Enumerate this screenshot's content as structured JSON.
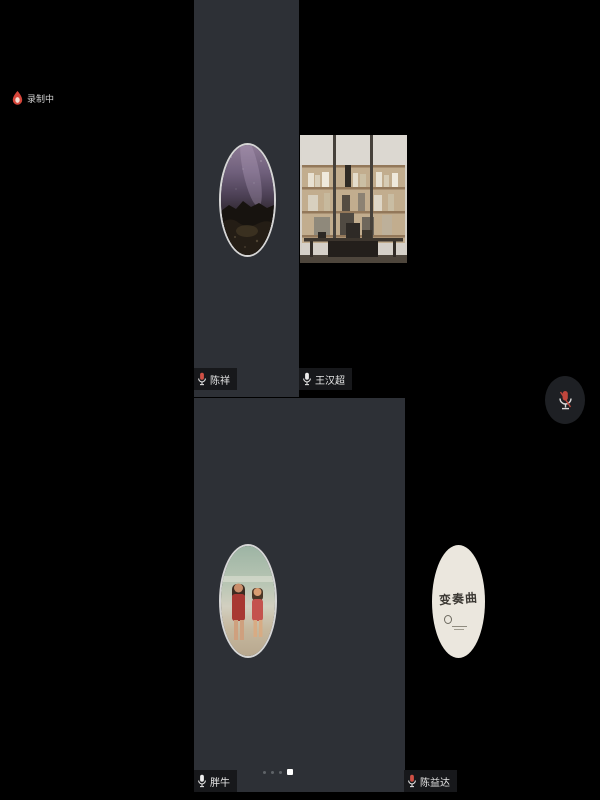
{
  "meeting": {
    "recording_indicator": {
      "icon": "recording-icon",
      "label": "录制中"
    },
    "floating_mic": {
      "icon": "mic-muted-icon",
      "state": "muted"
    },
    "pagination": {
      "dots": 4,
      "active_index": 3
    },
    "participants": [
      {
        "name": "陈祥",
        "mic": "muted",
        "avatar": "night-sky-photo"
      },
      {
        "name": "王汉超",
        "mic": "on",
        "avatar": "office-room-video"
      },
      {
        "name": "胖牛",
        "mic": "on",
        "avatar": "two-children-photo"
      },
      {
        "name": "陈益达",
        "mic": "muted",
        "avatar": "logo-badge",
        "badge_text": "变奏曲"
      }
    ],
    "colors": {
      "stage_bg": "#000000",
      "tile_bg": "#2d3036",
      "label_bg": "#17181b",
      "mic_muted_red": "#d05045",
      "logo_badge_bg": "#ebe7de",
      "dot_active": "#ffffff",
      "dot_inactive": "#5f6368"
    }
  }
}
